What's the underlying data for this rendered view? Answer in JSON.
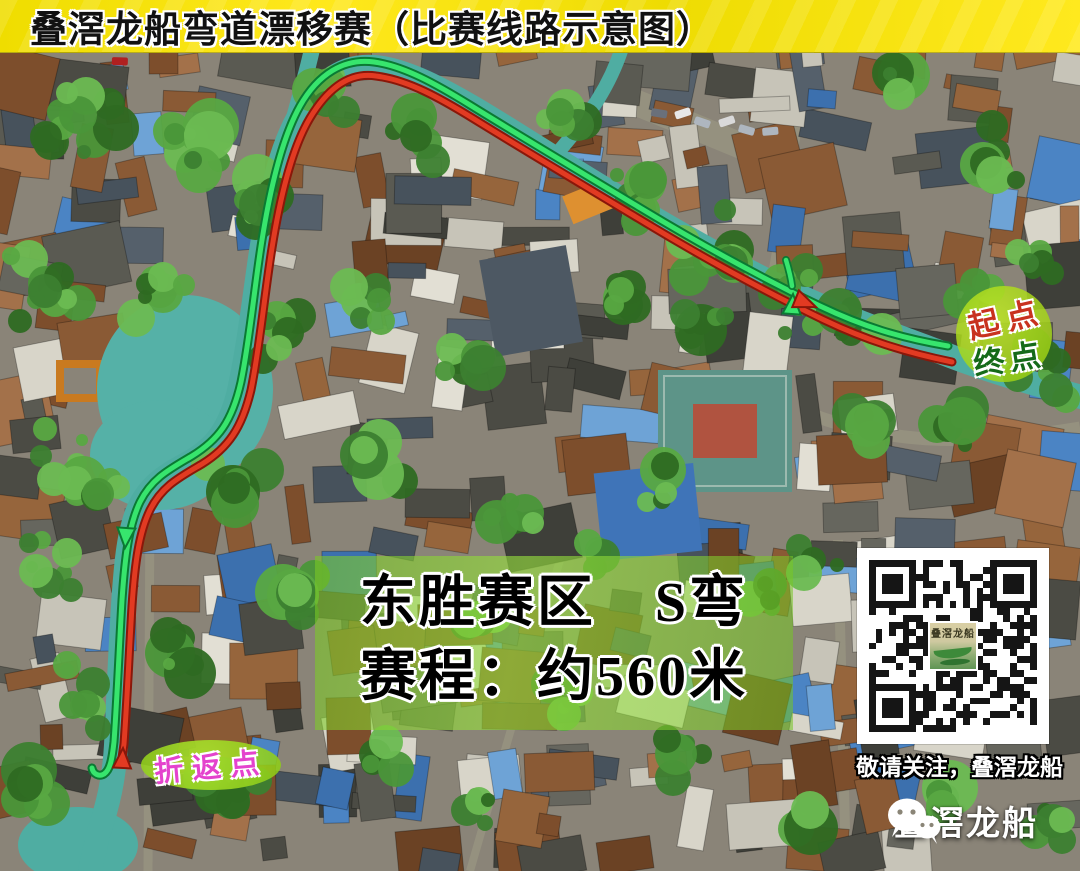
{
  "header": {
    "title": "叠滘龙船弯道漂移赛（比赛线路示意图）"
  },
  "map": {
    "type": "aerial-photo",
    "route": {
      "start_finish_label": {
        "line1": "起点",
        "line2": "终点"
      },
      "turnaround_label": "折返点",
      "outbound_line_color": "#e23a22",
      "outbound_edge_color": "#8a170a",
      "return_line_color": "#37e56d",
      "return_edge_color": "#0a7a33",
      "water_color": "#4fada2"
    }
  },
  "info_box": {
    "line1": "东胜赛区　S弯",
    "line2": "赛程：约560米",
    "background_color": "#7ec81e"
  },
  "qr": {
    "caption": "敬请关注，叠滘龙船",
    "logo_text": "叠滘龙船"
  },
  "footer": {
    "wechat_label": "叠滘龙船"
  },
  "colors": {
    "banner_yellow": "#f2e202",
    "start_label_red": "#c8321f",
    "finish_label_green": "#156a18",
    "turnaround_magenta": "#e443cd",
    "badge_green": "#a6d81c"
  }
}
